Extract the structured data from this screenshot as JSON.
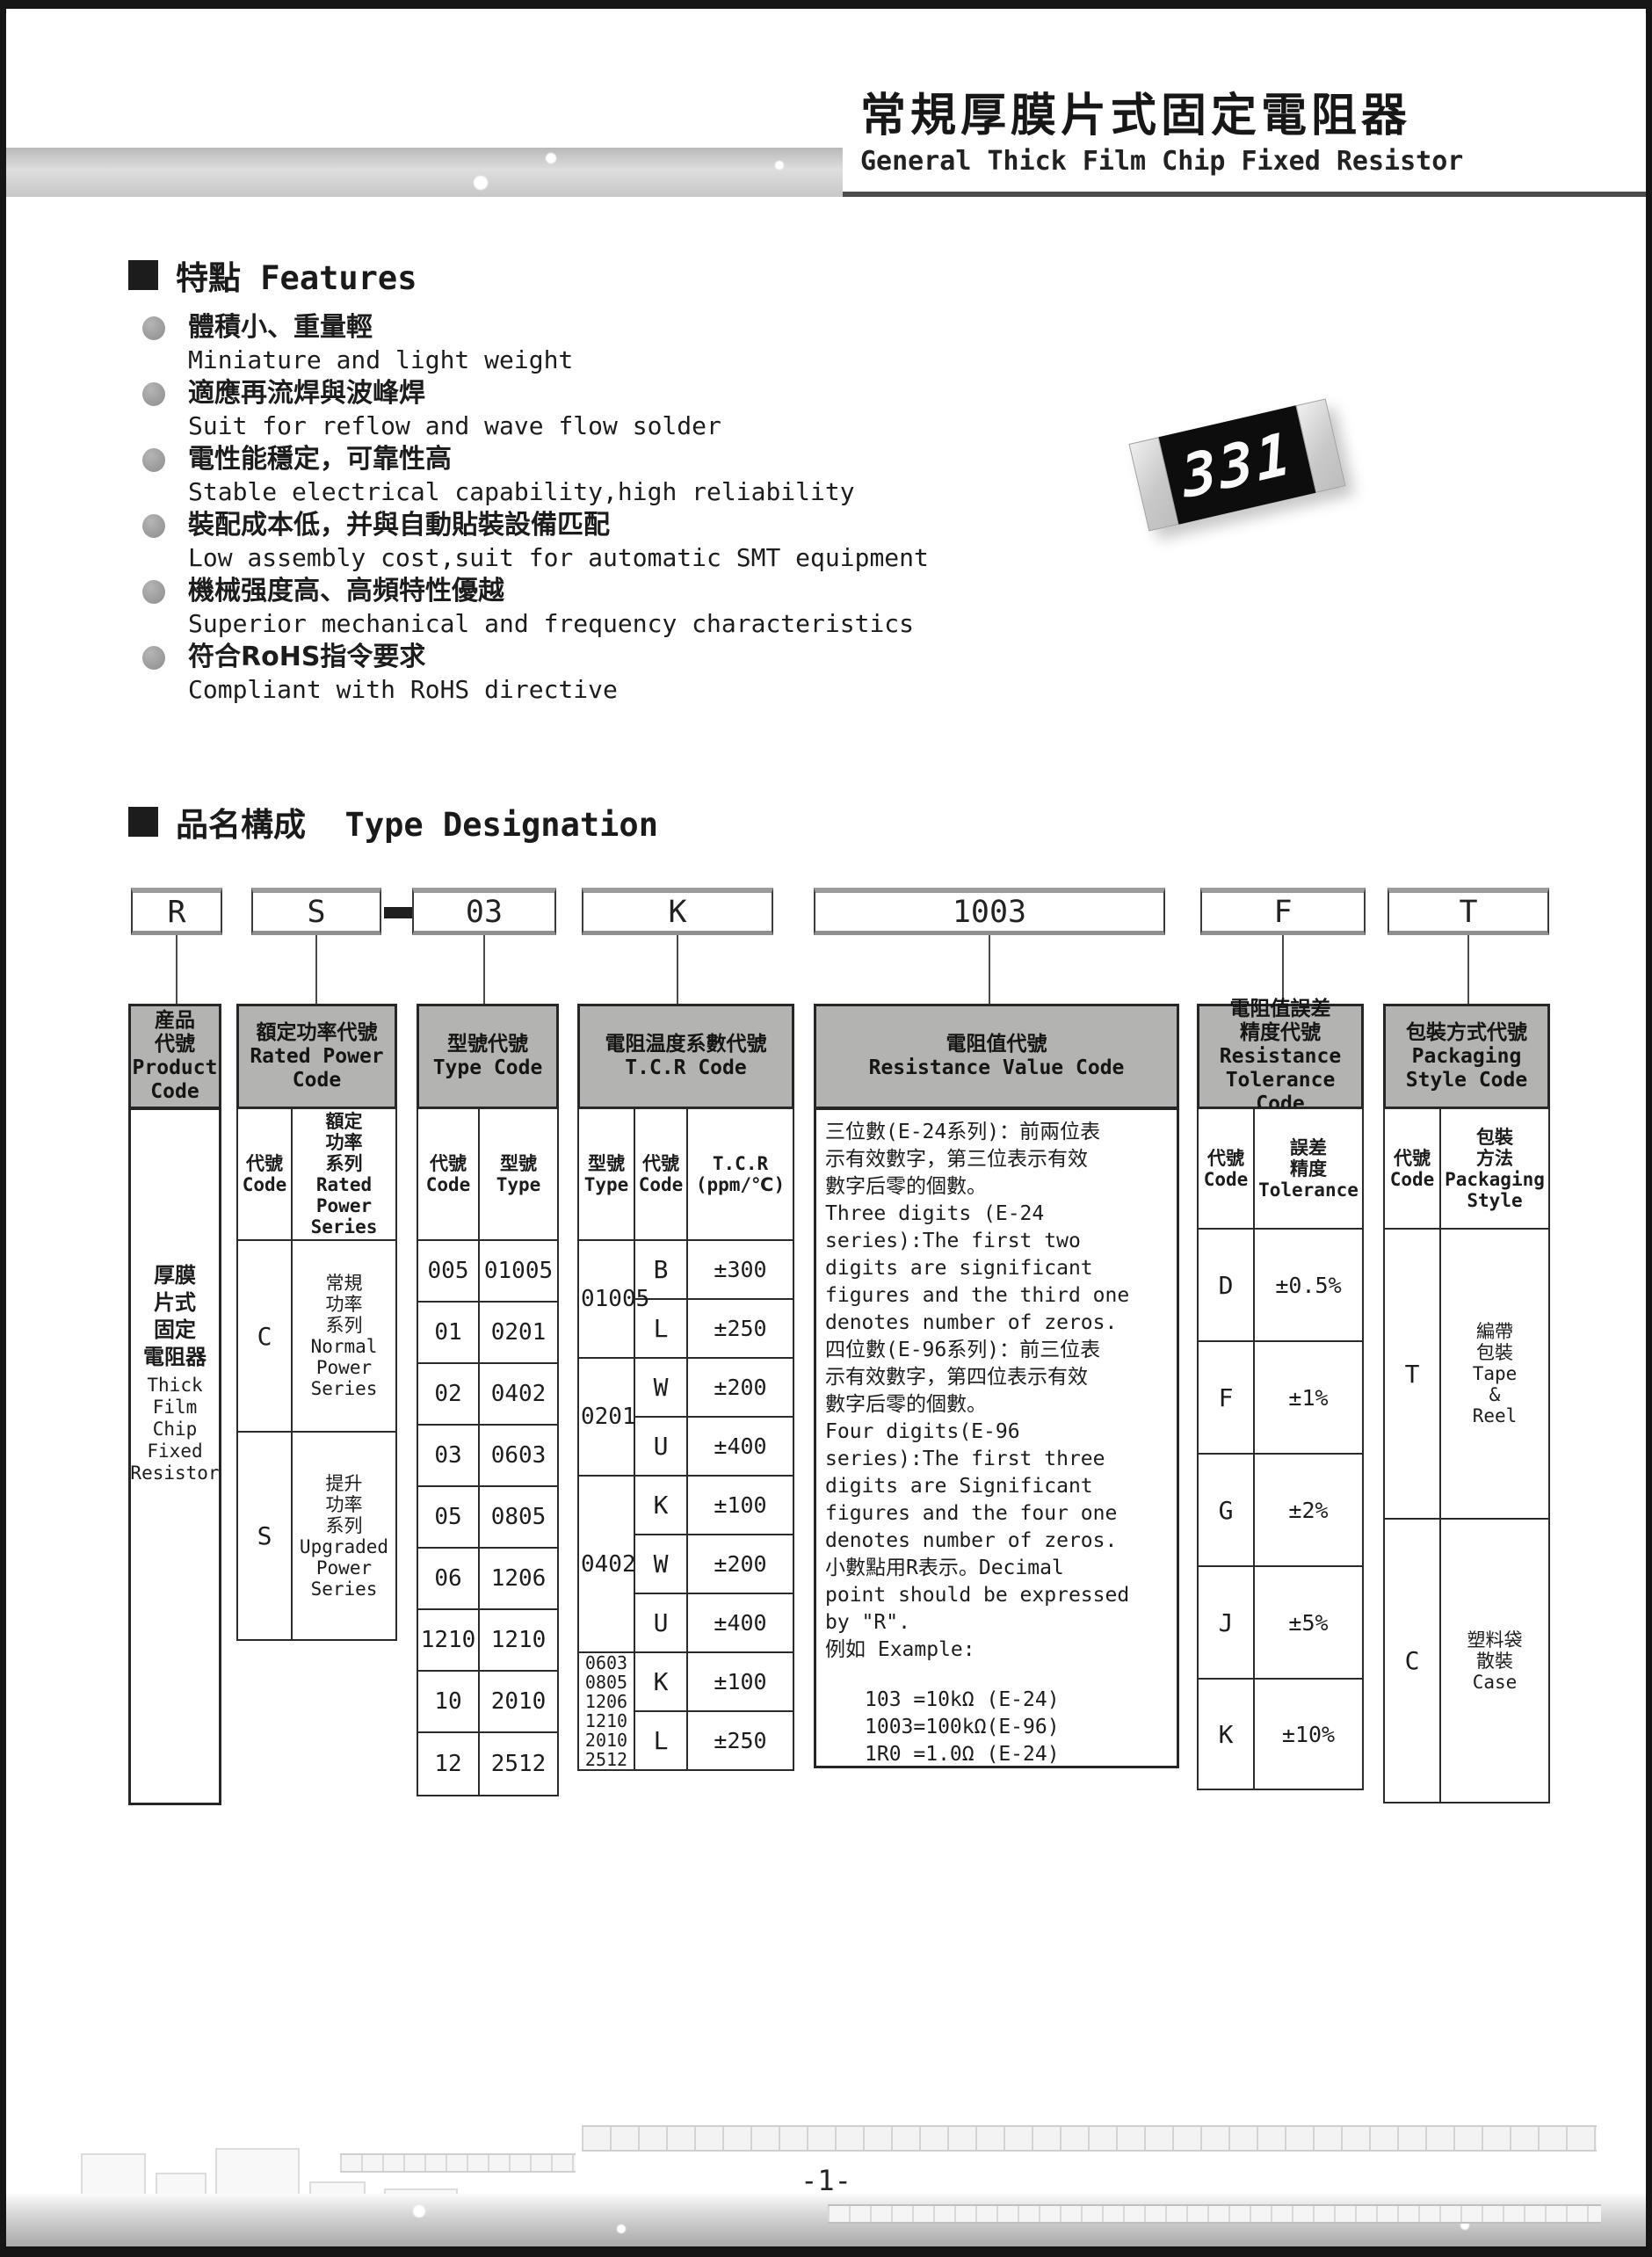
{
  "header": {
    "title_zh": "常規厚膜片式固定電阻器",
    "title_en": "General Thick Film Chip Fixed Resistor"
  },
  "features": {
    "heading": "特點 Features",
    "items": [
      {
        "zh": "體積小、重量輕",
        "en": "Miniature and light weight"
      },
      {
        "zh": "適應再流焊與波峰焊",
        "en": "Suit for reflow and wave flow solder"
      },
      {
        "zh": "電性能穩定，可靠性高",
        "en": "Stable electrical capability,high reliability"
      },
      {
        "zh": "裝配成本低，并與自動貼裝設備匹配",
        "en": "Low assembly cost,suit for automatic SMT equipment"
      },
      {
        "zh": "機械强度高、高頻特性優越",
        "en": "Superior mechanical and frequency characteristics"
      },
      {
        "zh": "符合RoHS指令要求",
        "en": "Compliant with RoHS directive"
      }
    ]
  },
  "resistor": {
    "marking": "331"
  },
  "type_designation": {
    "heading": "品名構成  Type Designation",
    "codes": {
      "product": "R",
      "power": "S",
      "type": "03",
      "tcr": "K",
      "resistance": "1003",
      "tolerance": "F",
      "packaging": "T"
    },
    "product": {
      "header": "産品\n代號\nProduct\nCode",
      "body_zh": "厚膜\n片式\n固定\n電阻器",
      "body_en": "Thick\nFilm\nChip\nFixed\nResistor"
    },
    "power": {
      "header": "額定功率代號\nRated Power\nCode",
      "sub_code": "代號\nCode",
      "sub_series": "額定\n功率\n系列\nRated\nPower\nSeries",
      "rows": [
        {
          "code": "C",
          "series": "常規\n功率\n系列\nNormal\nPower\nSeries"
        },
        {
          "code": "S",
          "series": "提升\n功率\n系列\nUpgraded\nPower\nSeries"
        }
      ]
    },
    "type": {
      "header": "型號代號\nType Code",
      "sub_code": "代號\nCode",
      "sub_type": "型號\nType",
      "rows": [
        {
          "code": "005",
          "type": "01005"
        },
        {
          "code": "01",
          "type": "0201"
        },
        {
          "code": "02",
          "type": "0402"
        },
        {
          "code": "03",
          "type": "0603"
        },
        {
          "code": "05",
          "type": "0805"
        },
        {
          "code": "06",
          "type": "1206"
        },
        {
          "code": "1210",
          "type": "1210"
        },
        {
          "code": "10",
          "type": "2010"
        },
        {
          "code": "12",
          "type": "2512"
        }
      ]
    },
    "tcr": {
      "header": "電阻温度系數代號\nT.C.R Code",
      "sub_type": "型號\nType",
      "sub_code": "代號\nCode",
      "sub_value": "T.C.R\n(ppm/℃)",
      "groups": [
        {
          "type": "01005",
          "rows": [
            {
              "code": "B",
              "value": "±300"
            },
            {
              "code": "L",
              "value": "±250"
            }
          ]
        },
        {
          "type": "0201",
          "rows": [
            {
              "code": "W",
              "value": "±200"
            },
            {
              "code": "U",
              "value": "±400"
            }
          ]
        },
        {
          "type": "0402",
          "rows": [
            {
              "code": "K",
              "value": "±100"
            },
            {
              "code": "W",
              "value": "±200"
            },
            {
              "code": "U",
              "value": "±400"
            }
          ]
        },
        {
          "type": "0603\n0805\n1206\n1210\n2010\n2512",
          "rows": [
            {
              "code": "K",
              "value": "±100"
            },
            {
              "code": "L",
              "value": "±250"
            }
          ]
        }
      ]
    },
    "resistance": {
      "header": "電阻值代號\nResistance Value Code",
      "body": "三位數(E-24系列)：前兩位表\n示有效數字，第三位表示有效\n數字后零的個數。\nThree digits (E-24\nseries):The first two\ndigits are significant\nfigures and the third one\ndenotes number of zeros.\n四位數(E-96系列)：前三位表\n示有效數字，第四位表示有效\n數字后零的個數。\nFour digits(E-96\nseries):The first three\ndigits are Significant\nfigures and the four one\ndenotes number of zeros.\n小數點用R表示。Decimal\npoint should be expressed\nby \"R\".\n例如 Example:",
      "examples": "103 =10kΩ (E-24)\n1003=100kΩ(E-96)\n1R0 =1.0Ω (E-24)"
    },
    "tolerance": {
      "header": "電阻值誤差\n精度代號\nResistance\nTolerance Code",
      "sub_code": "代號\nCode",
      "sub_tol": "誤差\n精度\nTolerance",
      "rows": [
        {
          "code": "D",
          "value": "±0.5%"
        },
        {
          "code": "F",
          "value": "±1%"
        },
        {
          "code": "G",
          "value": "±2%"
        },
        {
          "code": "J",
          "value": "±5%"
        },
        {
          "code": "K",
          "value": "±10%"
        }
      ]
    },
    "packaging": {
      "header": "包裝方式代號\nPackaging\nStyle Code",
      "sub_code": "代號\nCode",
      "sub_style": "包裝\n方法\nPackaging\nStyle",
      "rows": [
        {
          "code": "T",
          "style": "編帶\n包裝\nTape\n&\nReel"
        },
        {
          "code": "C",
          "style": "塑料袋\n散裝\nCase"
        }
      ]
    }
  },
  "footer": {
    "page_number": "-1-"
  }
}
